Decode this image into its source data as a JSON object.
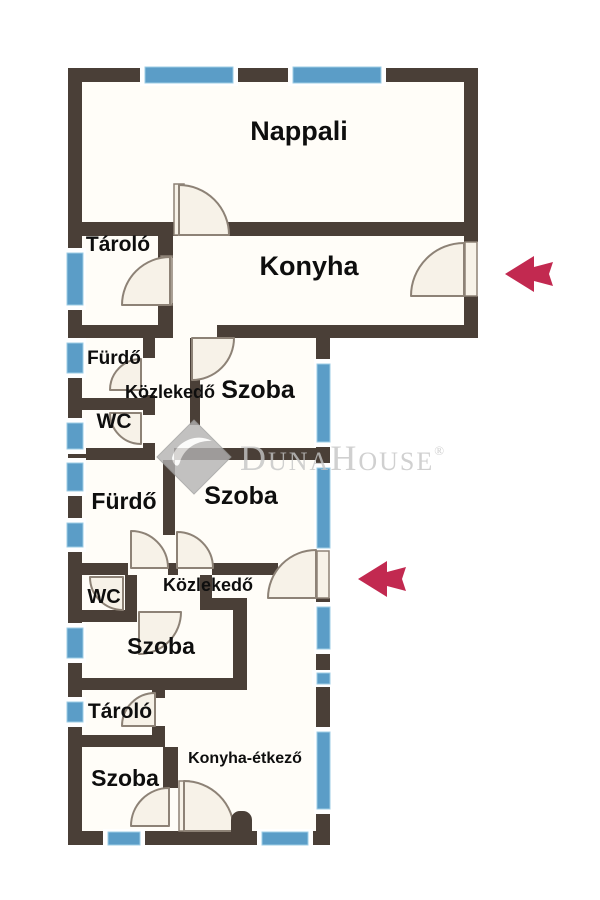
{
  "image_type": "apartment floor plan",
  "rooms": {
    "nappali": {
      "label": "Nappali"
    },
    "tarolo_1": {
      "label": "Tároló"
    },
    "konyha": {
      "label": "Konyha"
    },
    "furdo_1": {
      "label": "Fürdő"
    },
    "kozlekedo_1": {
      "label": "Közlekedő"
    },
    "szoba_1": {
      "label": "Szoba"
    },
    "wc_1": {
      "label": "WC"
    },
    "furdo_2": {
      "label": "Fürdő"
    },
    "szoba_2": {
      "label": "Szoba"
    },
    "wc_2": {
      "label": "WC"
    },
    "kozlekedo_2": {
      "label": "Közlekedő"
    },
    "szoba_3": {
      "label": "Szoba"
    },
    "tarolo_2": {
      "label": "Tároló"
    },
    "szoba_4": {
      "label": "Szoba"
    },
    "konyha_etkezo": {
      "label": "Konyha-étkező"
    }
  },
  "watermark": {
    "part1": "D",
    "part2": "UNA",
    "part3": "H",
    "part4": "OUSE",
    "registered": "®"
  },
  "icons": {
    "entrance_arrow_upper": {
      "name": "entrance-arrow-icon",
      "direction": "left"
    },
    "entrance_arrow_lower": {
      "name": "entrance-arrow-icon",
      "direction": "left"
    }
  },
  "colors": {
    "wall": "#4a3f37",
    "floor": "#fffdf8",
    "window_blue": "#5b9dc7",
    "window_edge": "#9ecde6",
    "door_fill": "#f7f2e8",
    "door_stroke": "#8d8276",
    "arrow_red": "#c22950",
    "watermark_gray": "#c5c5c5",
    "label_black": "#0e0e0e"
  }
}
